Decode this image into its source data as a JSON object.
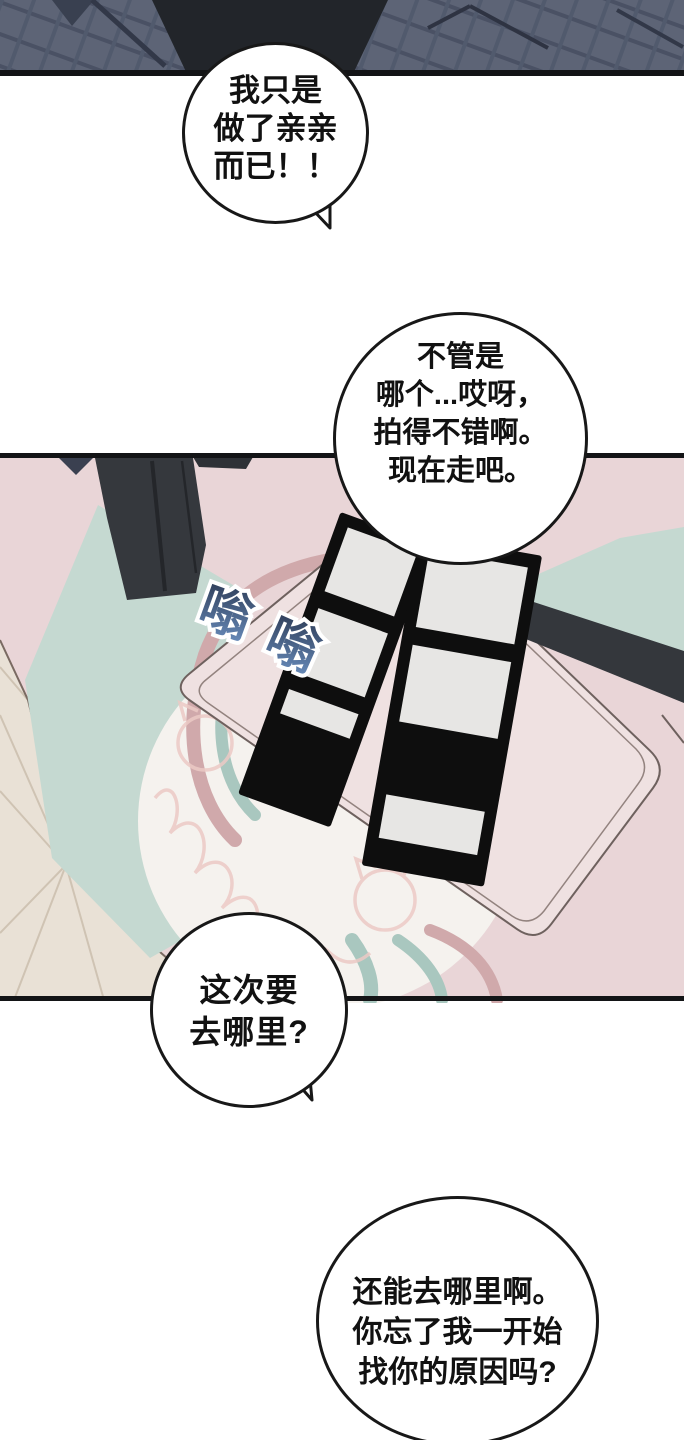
{
  "speech": {
    "bubble1": {
      "lines": [
        "我只是",
        "做了亲亲",
        "而已！！"
      ]
    },
    "bubble2": {
      "lines": [
        "不管是",
        "哪个...哎呀，",
        "拍得不错啊。",
        "现在走吧。"
      ]
    },
    "bubble3": {
      "lines": [
        "这次要",
        "去哪里?"
      ]
    },
    "bubble4": {
      "lines": [
        "还能去哪里啊。",
        "你忘了我一开始",
        "找你的原因吗?"
      ]
    }
  },
  "sfx": {
    "text": "嗡嗡",
    "char1": "嗡",
    "char2": "嗡",
    "color_top": "#2c3a54",
    "color_bottom": "#6486b4",
    "outline": "#ffffff"
  },
  "colors": {
    "panel_border": "#131416",
    "bubble_border": "#181818",
    "jacket_plaid": "#5d6476",
    "jacket_dark_center": "#22252a",
    "room_pink": "#e9d5d7",
    "table_pink": "#efe1e1",
    "floor_teal": "#c5d9d1",
    "swirl_teal": "#a9c7bf",
    "swirl_mauve": "#d0a9ab",
    "floor_beige": "#e9e1d6",
    "mat_white": "#f5f2ee",
    "photo_strip_black": "#0e0e0e",
    "photo_gray": "#e7e6e4",
    "furniture_dark": "#35383d",
    "doodle_pink": "#eccac5"
  }
}
